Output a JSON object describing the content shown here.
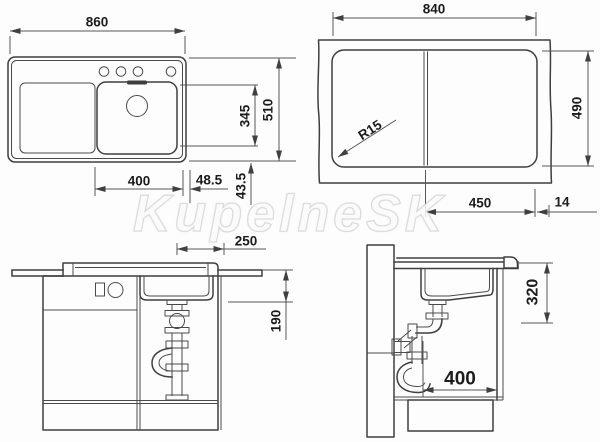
{
  "watermark": {
    "text": "KupelneSK"
  },
  "colors": {
    "background": "#fdfdfd",
    "outline": "#3f3f3f",
    "dimension_line": "#565656",
    "dimension_text": "#1c1c1c",
    "watermark_stroke": "#c4c4c4"
  },
  "top_view": {
    "width": "860",
    "overall_depth": "510",
    "bowl_depth": "345",
    "bowl_width": "400",
    "bowl_right_offset": "48.5",
    "bowl_bottom_offset": "43.5"
  },
  "cutout_view": {
    "cutout_width": "840",
    "cutout_depth": "490",
    "corner_radius": "R15",
    "right_section_width": "450",
    "edge_distance": "14"
  },
  "front_view": {
    "drain_to_edge": "250",
    "bowl_height": "190"
  },
  "side_view": {
    "mounting_depth": "320",
    "cabinet_depth": "400"
  }
}
